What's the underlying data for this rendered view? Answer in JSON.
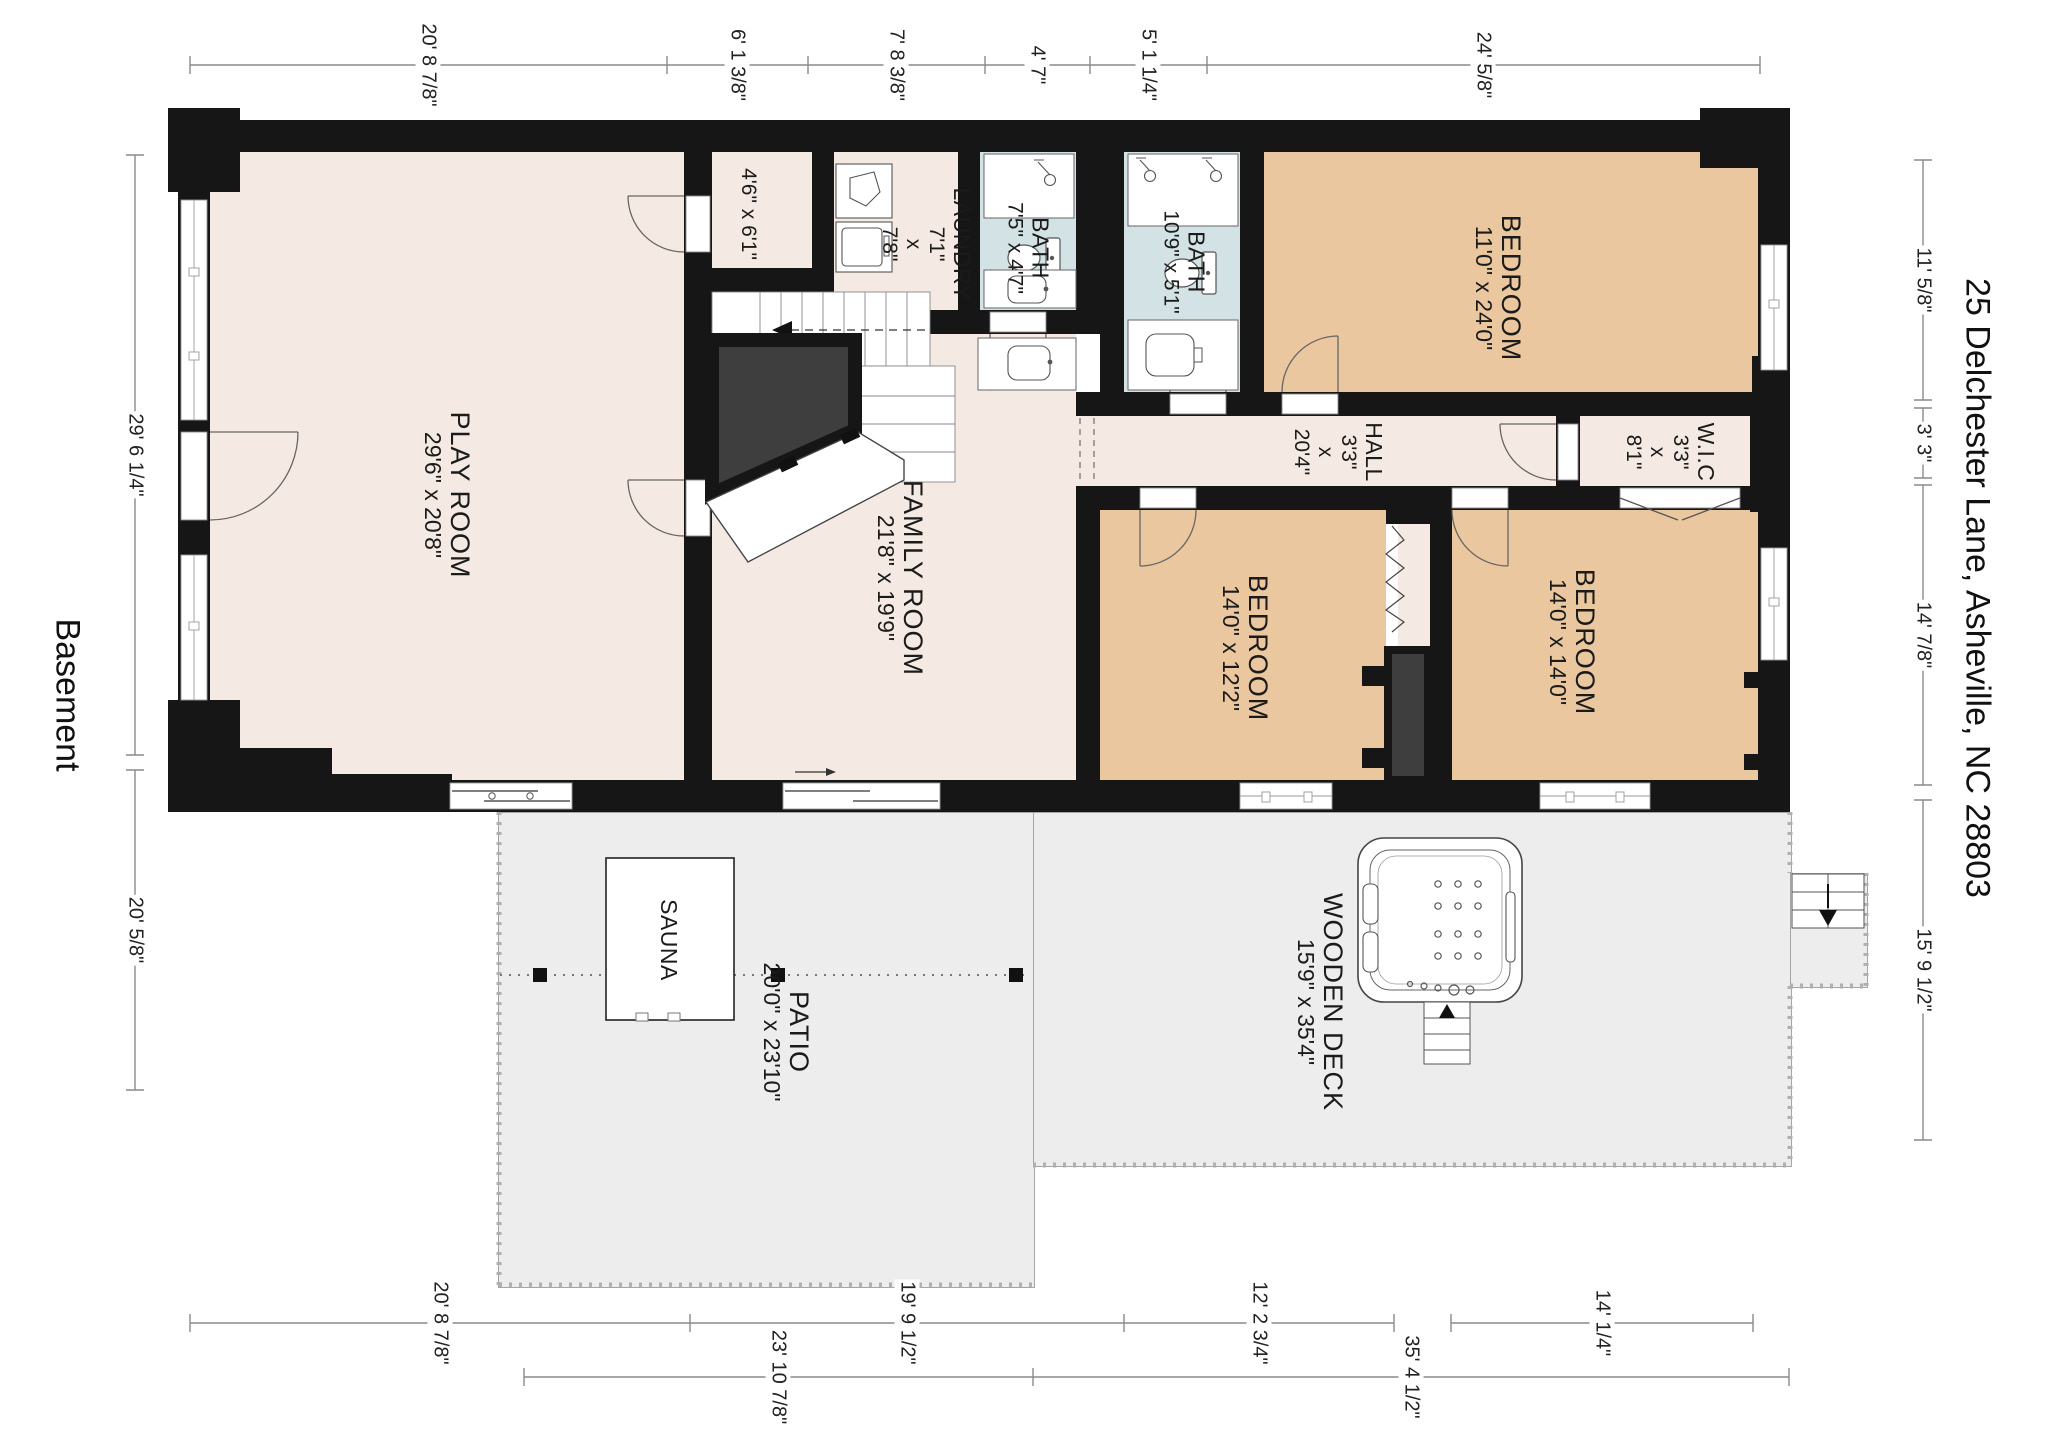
{
  "plan_title": "Basement",
  "address": "25 Delchester Lane, Asheville, NC 28803",
  "colors": {
    "wall": "#161616",
    "floor": "#f4eae3",
    "bedroom": "#eac79f",
    "bath": "#d3e3e5",
    "outdoor": "#ededed",
    "understair": "#3e3e3e",
    "dim_line": "#8a8a8a"
  },
  "rooms": {
    "playroom": {
      "name": "PLAY ROOM",
      "size": "29'6\" x 20'8\""
    },
    "family": {
      "name": "FAMILY ROOM",
      "size": "21'8\" x 19'9\""
    },
    "laundry": {
      "name": "LAUNDRY",
      "w": "7'1\"",
      "x": "x",
      "h": "7'8\""
    },
    "closet": {
      "size": "4'6\" x 6'1\""
    },
    "bath1": {
      "name": "BATH",
      "size": "7'5\" x 4'7\""
    },
    "bath2": {
      "name": "BATH",
      "size": "10'9\" x 5'1\""
    },
    "bedroom_top": {
      "name": "BEDROOM",
      "size": "11'0\" x 24'0\""
    },
    "hall": {
      "name": "HALL",
      "w": "3'3\"",
      "x": "x",
      "h": "20'4\""
    },
    "wic": {
      "name": "W.I.C",
      "w": "3'3\"",
      "x": "x",
      "h": "8'1\""
    },
    "bedroom_left": {
      "name": "BEDROOM",
      "size": "14'0\" x 12'2\""
    },
    "bedroom_right": {
      "name": "BEDROOM",
      "size": "14'0\" x 14'0\""
    },
    "sauna": {
      "name": "SAUNA"
    },
    "patio": {
      "name": "PATIO",
      "size": "20'0\" x 23'10\""
    },
    "deck": {
      "name": "WOODEN DECK",
      "size": "15'9\" x 35'4\""
    }
  },
  "dims": {
    "top": [
      "20' 8 7/8\"",
      "6' 1 3/8\"",
      "7' 8 3/8\"",
      "4' 7\"",
      "5' 1 1/4\"",
      "24' 5/8\""
    ],
    "left": [
      "29' 6 1/4\"",
      "20' 5/8\""
    ],
    "right": [
      "11' 5/8\"",
      "3' 3\"",
      "14' 7/8\"",
      "15' 9 1/2\""
    ],
    "bottom_inner": [
      "20' 8 7/8\"",
      "19' 9 1/2\"",
      "12' 2 3/4\"",
      "14' 1/4\""
    ],
    "bottom_outer": [
      "23' 10 7/8\"",
      "35' 4 1/2\""
    ]
  }
}
